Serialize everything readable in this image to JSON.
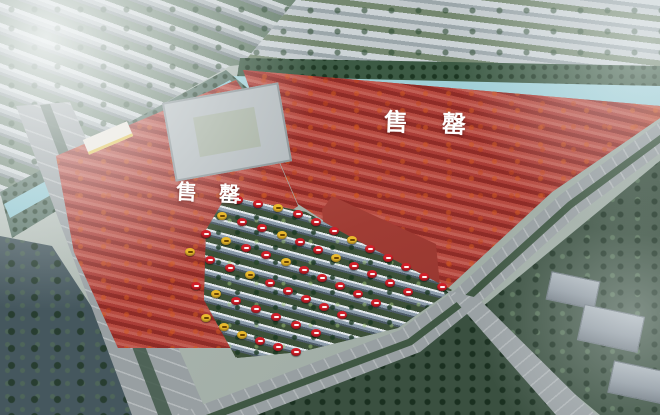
{
  "labels": {
    "left_parcel_status": "售罄",
    "right_parcel_status": "售罄"
  },
  "palette": {
    "sold_out_overlay": "#b44a42",
    "sold_out_wash": "#c81c14",
    "orange_trees": "#d47026",
    "canal_water": "#8fc6d0",
    "road_gray": "#989fa2",
    "available_green": "#4e6049",
    "roof_slate": "#8d9dac",
    "city_gray": "#a9b2b5",
    "dark_water": "#45575e",
    "park_green": "#3a5040",
    "marker_red": "#d2202a",
    "marker_yellow": "#e9b92d"
  },
  "markers": {
    "colors": {
      "red": "#d2202a",
      "yellow": "#e9b92d"
    },
    "items": [
      {
        "x": 238,
        "y": 200,
        "c": "red"
      },
      {
        "x": 258,
        "y": 204,
        "c": "red"
      },
      {
        "x": 278,
        "y": 208,
        "c": "yellow"
      },
      {
        "x": 298,
        "y": 214,
        "c": "red"
      },
      {
        "x": 316,
        "y": 222,
        "c": "red"
      },
      {
        "x": 334,
        "y": 231,
        "c": "red"
      },
      {
        "x": 352,
        "y": 240,
        "c": "yellow"
      },
      {
        "x": 370,
        "y": 249,
        "c": "red"
      },
      {
        "x": 388,
        "y": 258,
        "c": "red"
      },
      {
        "x": 406,
        "y": 267,
        "c": "red"
      },
      {
        "x": 424,
        "y": 277,
        "c": "red"
      },
      {
        "x": 442,
        "y": 287,
        "c": "red"
      },
      {
        "x": 222,
        "y": 216,
        "c": "yellow"
      },
      {
        "x": 242,
        "y": 222,
        "c": "red"
      },
      {
        "x": 262,
        "y": 228,
        "c": "red"
      },
      {
        "x": 282,
        "y": 235,
        "c": "yellow"
      },
      {
        "x": 300,
        "y": 242,
        "c": "red"
      },
      {
        "x": 318,
        "y": 250,
        "c": "red"
      },
      {
        "x": 336,
        "y": 258,
        "c": "yellow"
      },
      {
        "x": 354,
        "y": 266,
        "c": "red"
      },
      {
        "x": 372,
        "y": 274,
        "c": "red"
      },
      {
        "x": 390,
        "y": 283,
        "c": "red"
      },
      {
        "x": 408,
        "y": 292,
        "c": "red"
      },
      {
        "x": 206,
        "y": 234,
        "c": "red"
      },
      {
        "x": 226,
        "y": 241,
        "c": "yellow"
      },
      {
        "x": 246,
        "y": 248,
        "c": "red"
      },
      {
        "x": 266,
        "y": 255,
        "c": "red"
      },
      {
        "x": 286,
        "y": 262,
        "c": "yellow"
      },
      {
        "x": 304,
        "y": 270,
        "c": "red"
      },
      {
        "x": 322,
        "y": 278,
        "c": "red"
      },
      {
        "x": 340,
        "y": 286,
        "c": "red"
      },
      {
        "x": 358,
        "y": 294,
        "c": "red"
      },
      {
        "x": 376,
        "y": 303,
        "c": "red"
      },
      {
        "x": 190,
        "y": 252,
        "c": "yellow"
      },
      {
        "x": 210,
        "y": 260,
        "c": "red"
      },
      {
        "x": 230,
        "y": 268,
        "c": "red"
      },
      {
        "x": 250,
        "y": 275,
        "c": "yellow"
      },
      {
        "x": 270,
        "y": 283,
        "c": "red"
      },
      {
        "x": 288,
        "y": 291,
        "c": "red"
      },
      {
        "x": 306,
        "y": 299,
        "c": "red"
      },
      {
        "x": 324,
        "y": 307,
        "c": "red"
      },
      {
        "x": 342,
        "y": 315,
        "c": "red"
      },
      {
        "x": 196,
        "y": 286,
        "c": "red"
      },
      {
        "x": 216,
        "y": 294,
        "c": "yellow"
      },
      {
        "x": 236,
        "y": 301,
        "c": "red"
      },
      {
        "x": 256,
        "y": 309,
        "c": "red"
      },
      {
        "x": 276,
        "y": 317,
        "c": "red"
      },
      {
        "x": 296,
        "y": 325,
        "c": "red"
      },
      {
        "x": 316,
        "y": 333,
        "c": "red"
      },
      {
        "x": 206,
        "y": 318,
        "c": "yellow"
      },
      {
        "x": 224,
        "y": 327,
        "c": "yellow"
      },
      {
        "x": 242,
        "y": 335,
        "c": "yellow"
      },
      {
        "x": 260,
        "y": 341,
        "c": "red"
      },
      {
        "x": 278,
        "y": 347,
        "c": "red"
      },
      {
        "x": 296,
        "y": 352,
        "c": "red"
      }
    ]
  }
}
